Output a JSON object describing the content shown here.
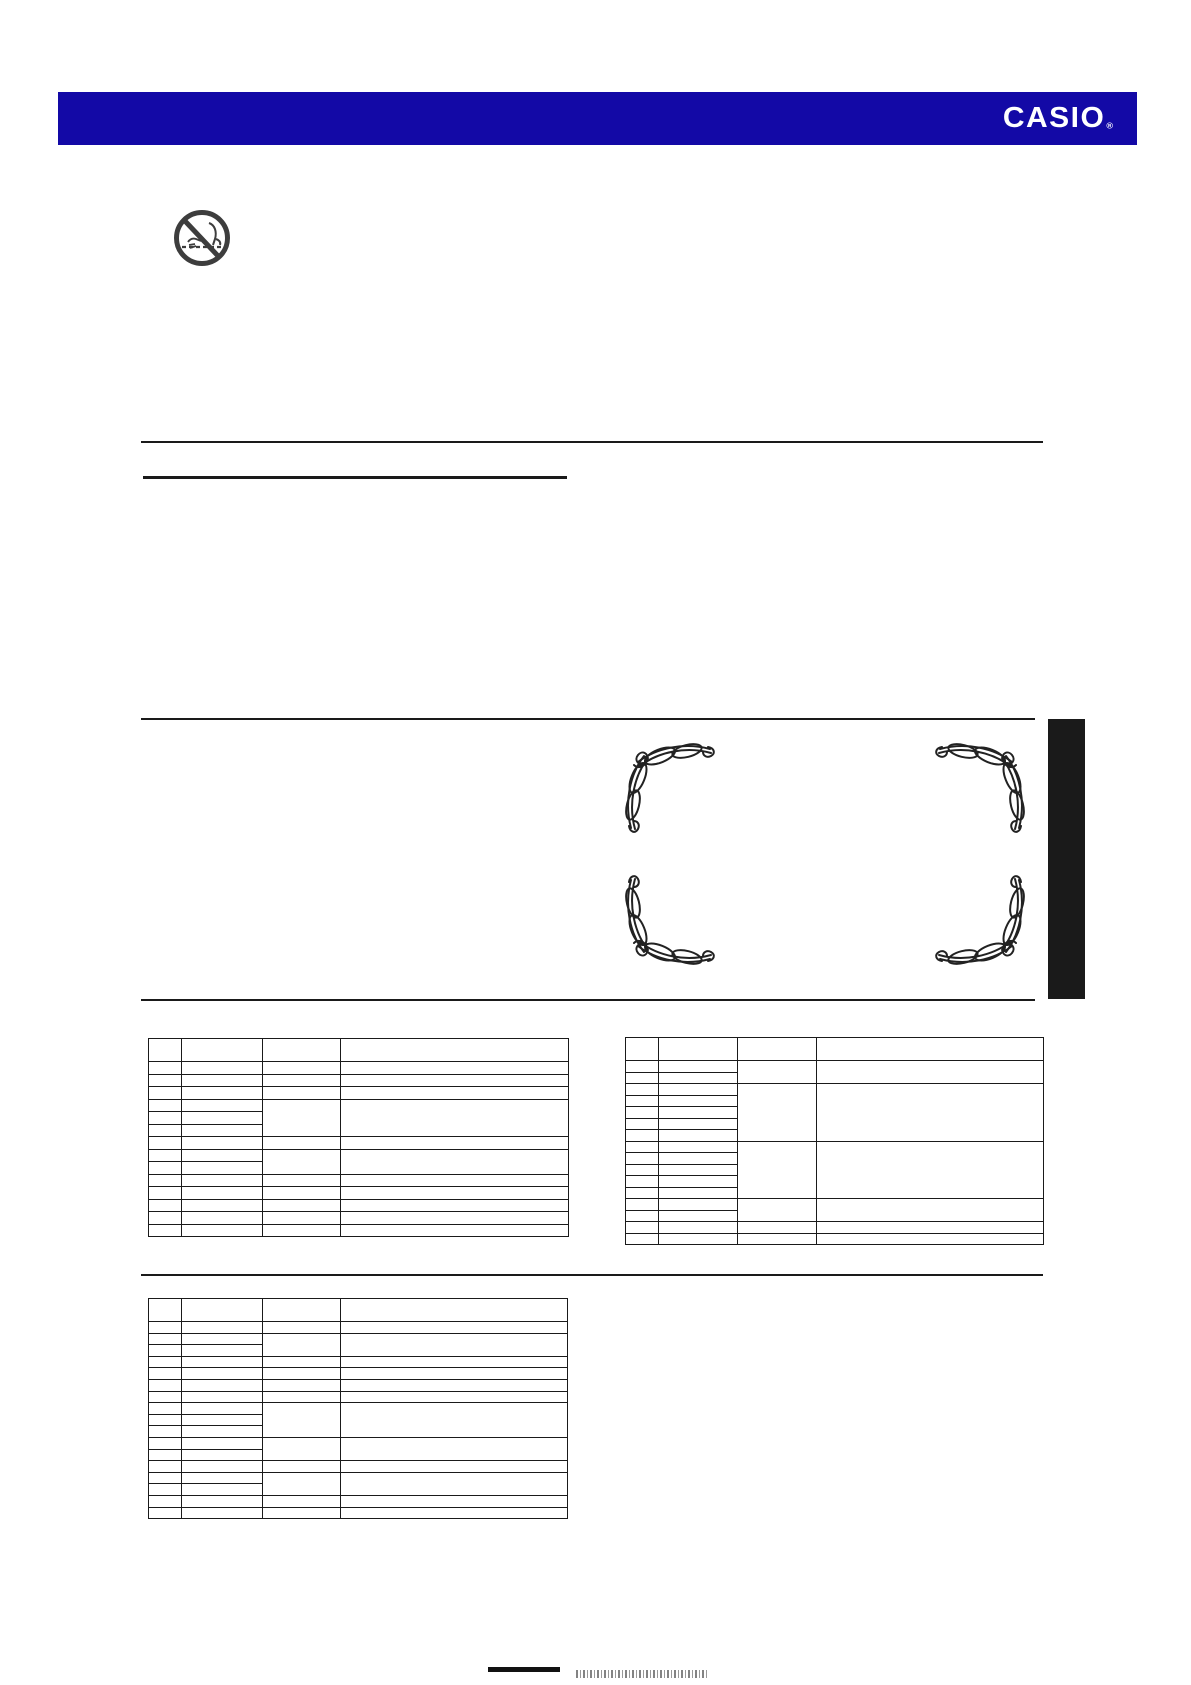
{
  "page": {
    "width": 1191,
    "height": 1685,
    "background": "#ffffff"
  },
  "header": {
    "brand": "CASIO",
    "registered_mark": "®",
    "bar_color": "#1309A6",
    "text_color": "#ffffff"
  },
  "icons": {
    "prohibition": "do-not-pry-open-case-icon",
    "prohibition_color": "#3d3d3d",
    "flourish": "calligraphic-corner-ornament",
    "flourish_color": "#222222"
  },
  "decor": {
    "ink_color": "#1a1a1a",
    "side_tab_color": "#1a1a1a",
    "ornament_corners": [
      "top-left",
      "top-right",
      "bottom-left",
      "bottom-right"
    ]
  },
  "tables": {
    "note": "all table cells are empty in the scan",
    "top_left": {
      "col_widths": [
        33,
        81,
        78,
        228
      ],
      "header_height": 23,
      "row_height": 12.5,
      "groups": [
        {
          "rows": 3,
          "merged_cols_3_4": false
        },
        {
          "rows": 3,
          "merged_cols_3_4": true
        },
        {
          "rows": 1,
          "merged_cols_3_4": false
        },
        {
          "rows": 2,
          "merged_cols_3_4": true
        },
        {
          "rows": 5,
          "merged_cols_3_4": false
        }
      ]
    },
    "top_right": {
      "col_widths": [
        33,
        79,
        79,
        227
      ],
      "header_height": 23,
      "row_height": 11.5,
      "groups": [
        {
          "rows": 2,
          "merged_cols_3_4": true
        },
        {
          "rows": 5,
          "merged_cols_3_4": true
        },
        {
          "rows": 5,
          "merged_cols_3_4": true
        },
        {
          "rows": 2,
          "merged_cols_3_4": true
        },
        {
          "rows": 2,
          "merged_cols_3_4": false
        }
      ]
    },
    "bottom_left": {
      "col_widths": [
        33,
        81,
        78,
        227
      ],
      "header_height": 23,
      "row_height": 11.6,
      "groups": [
        {
          "rows": 1,
          "merged_cols_3_4": false
        },
        {
          "rows": 2,
          "merged_cols_3_4": true
        },
        {
          "rows": 4,
          "merged_cols_3_4": false
        },
        {
          "rows": 3,
          "merged_cols_3_4": true
        },
        {
          "rows": 2,
          "merged_cols_3_4": true
        },
        {
          "rows": 1,
          "merged_cols_3_4": false
        },
        {
          "rows": 2,
          "merged_cols_3_4": true
        },
        {
          "rows": 2,
          "merged_cols_3_4": false
        }
      ]
    }
  }
}
